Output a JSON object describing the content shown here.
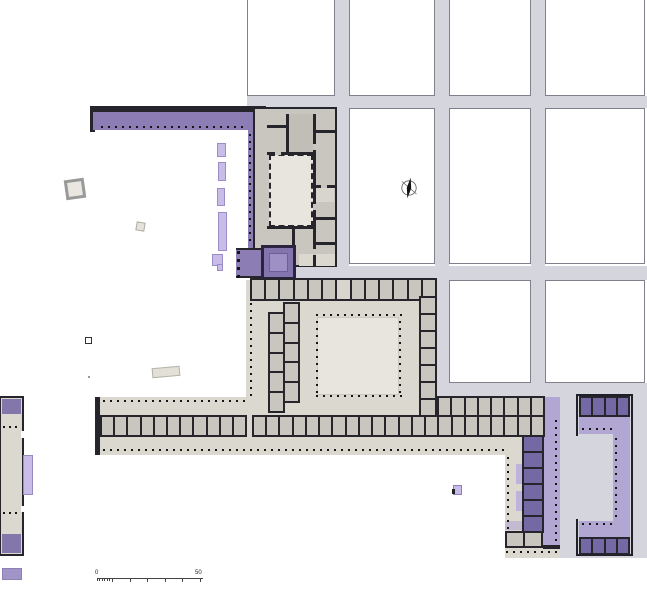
{
  "scale_bar": {
    "start_label": "0",
    "end_label": "50"
  },
  "compass": {
    "icon": "north-arrow"
  },
  "colors": {
    "street": "#d5d5dd",
    "street_border": "#80808a",
    "wall": "#25252b",
    "room_gray": "#c9c6c0",
    "room_gray_dark": "#c1beb8",
    "room_light": "#d8d5ce",
    "hall_beige": "#dbd8d0",
    "court_beige": "#e7e5dd",
    "stoa_purple": "#8c7eb4",
    "room_purple": "#7569a5",
    "portico_lavender": "#b2a6d3",
    "lilac": "#c9bce9",
    "west_band_purple": "#8276ab",
    "detached_purple": "#a195c8",
    "dot": "#151515"
  }
}
